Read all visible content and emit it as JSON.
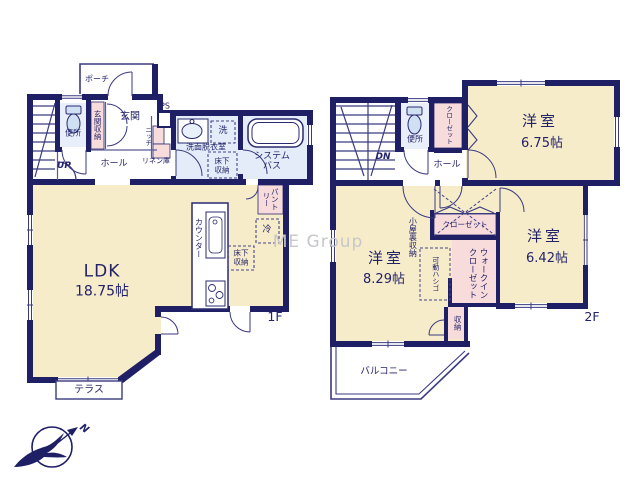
{
  "watermark": "ME Group",
  "compass": {
    "north": "N"
  },
  "f1": {
    "floor_tag": "1F",
    "porch": "ポーチ",
    "toilet": "便所",
    "entrance_storage": "玄関収納",
    "entrance": "玄関",
    "ps": "PS",
    "niche": "ニッチ",
    "linen": "リネン庫",
    "hall": "ホール",
    "up": "UP",
    "washroom": "洗面脱衣室",
    "washer": "洗",
    "underfloor1": "床下収納",
    "bath": "システムバス",
    "counter": "カウンター",
    "pantry": "パントリー",
    "fridge": "冷",
    "underfloor2": "床下収納",
    "ldk_name": "LDK",
    "ldk_size": "18.75帖",
    "terrace": "テラス"
  },
  "f2": {
    "floor_tag": "2F",
    "dn": "DN",
    "toilet": "便所",
    "closet_n": "クローゼット",
    "hall": "ホール",
    "room1_name": "洋室",
    "room1_size": "6.75帖",
    "room2_name": "洋室",
    "room2_size": "8.29帖",
    "room3_name": "洋室",
    "room3_size": "6.42帖",
    "attic": "小屋裏収納",
    "closet_s": "クローゼット",
    "wic": "ウォークインクローゼット",
    "ladder": "可動ハシゴ",
    "storage": "収納",
    "balcony": "バルコニー"
  },
  "colors": {
    "wall": "#1f1f66",
    "room_cream": "#f7ecca",
    "closet_pink": "#f8dcdc",
    "wet_blue": "#e3ecf8",
    "fixture_blue": "#cfe0f2",
    "text": "#22226a",
    "watermark_gray": "#c7c7cb"
  }
}
